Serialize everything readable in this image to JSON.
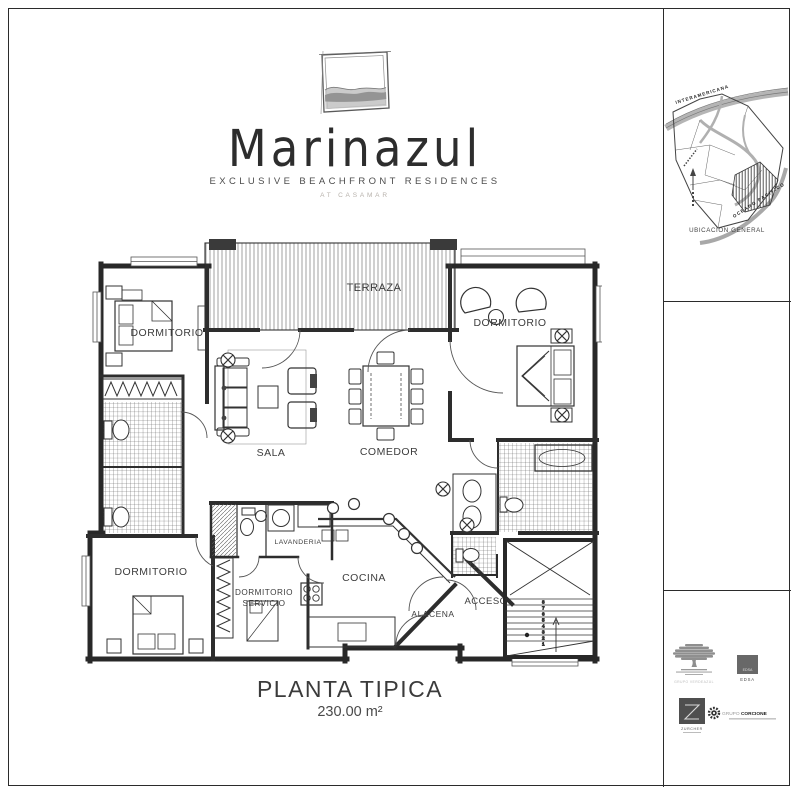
{
  "brand": {
    "name": "Marinazul",
    "subtitle": "EXCLUSIVE BEACHFRONT RESIDENCES",
    "tagline": "AT CASAMAR"
  },
  "plan": {
    "title": "PLANTA TIPICA",
    "area": "230.00 m²",
    "rooms": {
      "terraza": "TERRAZA",
      "dormitorio_izq": "DORMITORIO",
      "dormitorio_der": "DORMITORIO",
      "dormitorio_inf": "DORMITORIO",
      "sala": "SALA",
      "comedor": "COMEDOR",
      "lavanderia": "LAVANDERIA",
      "servicio_l1": "DORMITORIO",
      "servicio_l2": "SERVICIO",
      "cocina": "COCINA",
      "alacena": "ALACENA",
      "acceso": "ACCESO"
    },
    "stairs": [
      "8",
      "7",
      "6",
      "5",
      "4",
      "3",
      "2",
      "1"
    ]
  },
  "sidebar": {
    "map": {
      "road_top": "INTERAMERICANA",
      "ocean": "OCEANO PACIFICO",
      "caption": "UBICACION GENERAL"
    },
    "logos": {
      "verdeazul": "GRUPO VERDEAZUL",
      "edsa_mark": "EDSA",
      "edsa": "EDSA",
      "zurcher": "ZURCHER",
      "corcione_a": "GRUPO",
      "corcione_b": "CORCIONE"
    }
  },
  "colors": {
    "ink": "#2b2b2b",
    "hatch": "#666666",
    "soft_gray": "#9a9a9a"
  }
}
